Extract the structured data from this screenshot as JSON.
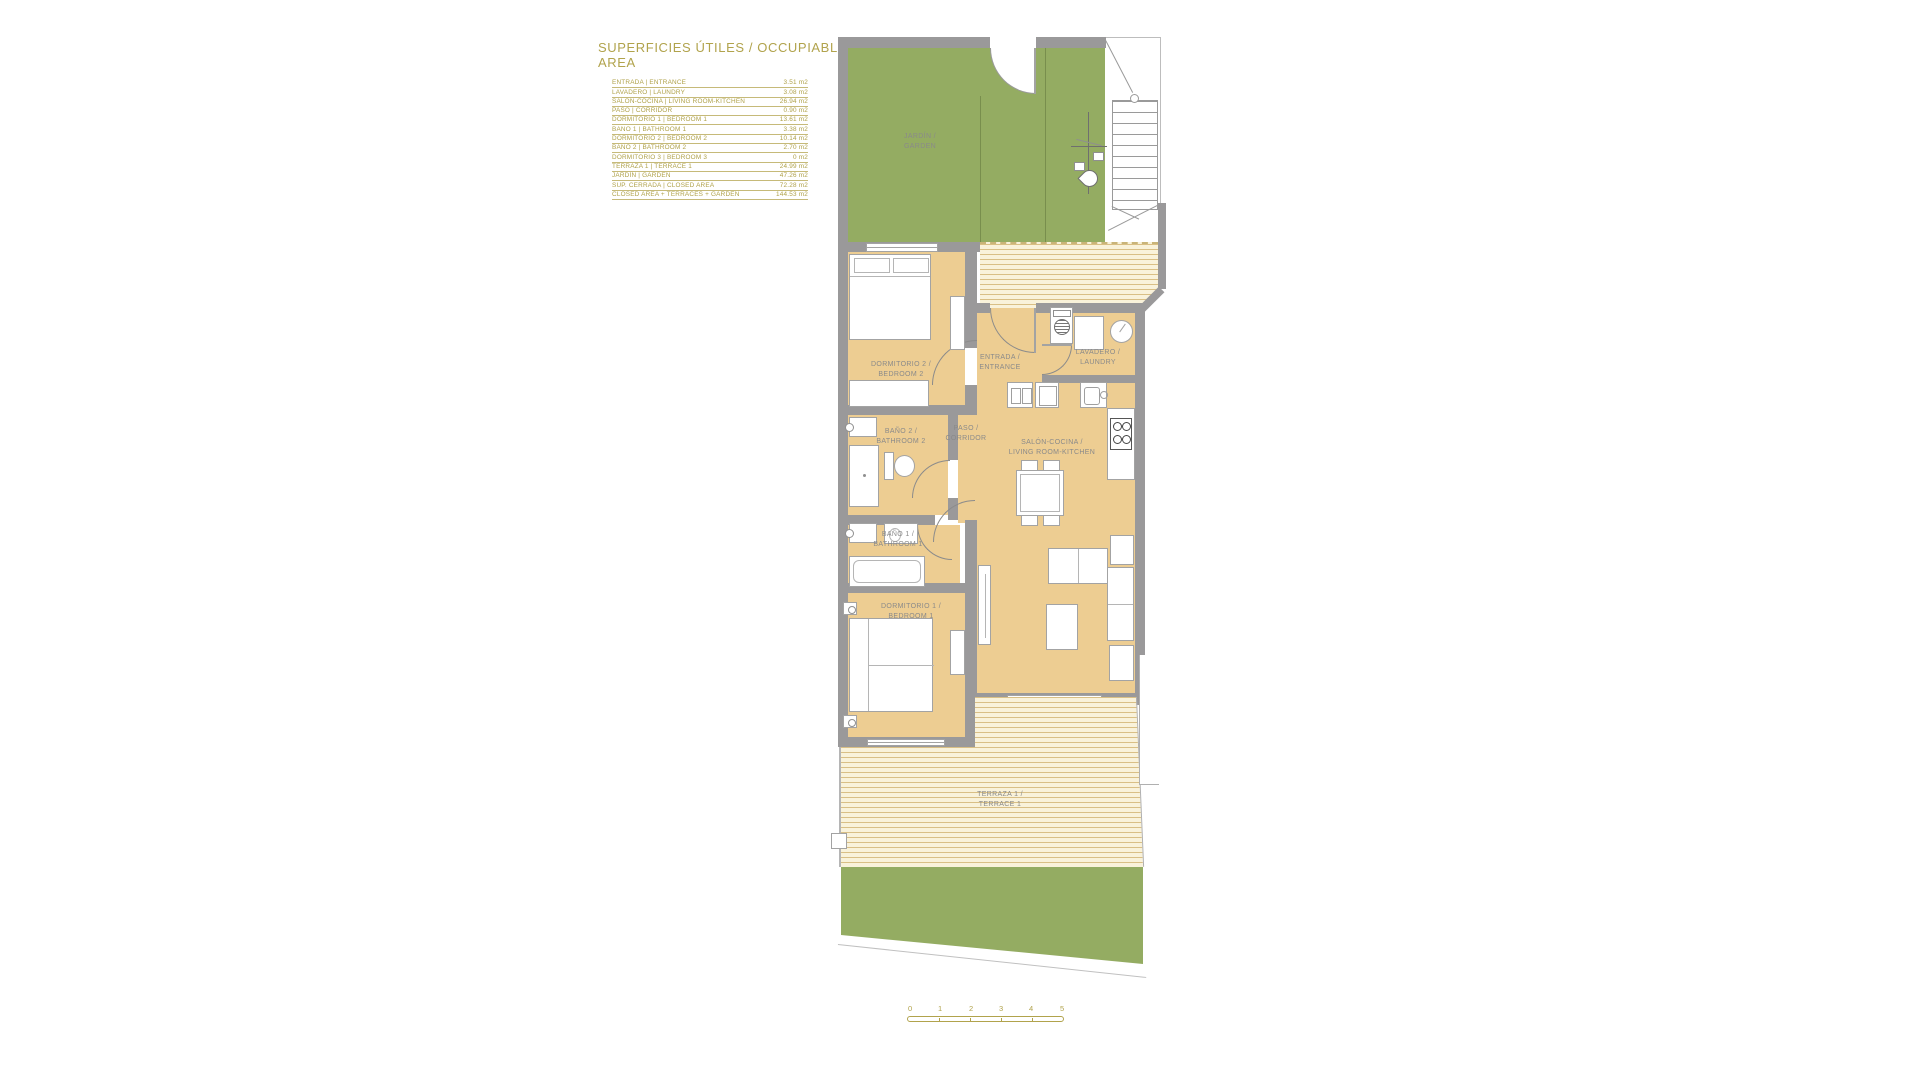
{
  "colors": {
    "accent_olive": "#b1a34c",
    "label_gray": "#8a8a8a",
    "wall_gray": "#9a999a",
    "floor_tan": "#edcd92",
    "garden_green": "#94ac62",
    "deck_cream": "#f9f2da",
    "deck_line": "#d9bf85"
  },
  "legend": {
    "title": "SUPERFICIES ÚTILES / OCCUPIABLE AREA",
    "rows": [
      {
        "label": "ENTRADA | ENTRANCE",
        "value": "3.51 m2"
      },
      {
        "label": "LAVADERO | LAUNDRY",
        "value": "3.08 m2"
      },
      {
        "label": "SALÓN-COCINA | LIVING ROOM-KITCHEN",
        "value": "26.94 m2"
      },
      {
        "label": "PASO | CORRIDOR",
        "value": "0.90 m2"
      },
      {
        "label": "DORMITORIO 1 | BEDROOM 1",
        "value": "13.61 m2"
      },
      {
        "label": "BAÑO 1 | BATHROOM 1",
        "value": "3.38 m2"
      },
      {
        "label": "DORMITORIO 2 | BEDROOM 2",
        "value": "10.14 m2"
      },
      {
        "label": "BAÑO 2 | BATHROOM 2",
        "value": "2.70 m2"
      },
      {
        "label": "DORMITORIO 3 | BEDROOM 3",
        "value": "0 m2"
      },
      {
        "label": "TERRAZA 1 | TERRACE 1",
        "value": "24.99 m2"
      },
      {
        "label": "JARDÍN | GARDEN",
        "value": "47.26 m2"
      }
    ],
    "totals": [
      {
        "label": "SUP. CERRADA | CLOSED AREA",
        "value": "72.28 m2"
      },
      {
        "label": "CLOSED AREA + TERRACES + GARDEN",
        "value": "144.53 m2"
      }
    ]
  },
  "plan": {
    "rooms": {
      "jardin": {
        "line1": "JARDÍN /",
        "line2": "GARDEN"
      },
      "dormitorio2": {
        "line1": "DORMITORIO 2 /",
        "line2": "BEDROOM 2"
      },
      "entrada": {
        "line1": "ENTRADA /",
        "line2": "ENTRANCE"
      },
      "lavadero": {
        "line1": "LAVADERO /",
        "line2": "LAUNDRY"
      },
      "paso": {
        "line1": "PASO /",
        "line2": "CORRIDOR"
      },
      "salon": {
        "line1": "SALÓN-COCINA /",
        "line2": "LIVING ROOM-KITCHEN"
      },
      "bano2": {
        "line1": "BAÑO 2 /",
        "line2": "BATHROOM 2"
      },
      "bano1": {
        "line1": "BAÑO 1 /",
        "line2": "BATHROOM 1"
      },
      "dormitorio1": {
        "line1": "DORMITORIO 1 /",
        "line2": "BEDROOM 1"
      },
      "terraza": {
        "line1": "TERRAZA 1 /",
        "line2": "TERRACE 1"
      }
    }
  },
  "scale_bar": {
    "labels": [
      "0",
      "1",
      "2",
      "3",
      "4",
      "5"
    ]
  }
}
